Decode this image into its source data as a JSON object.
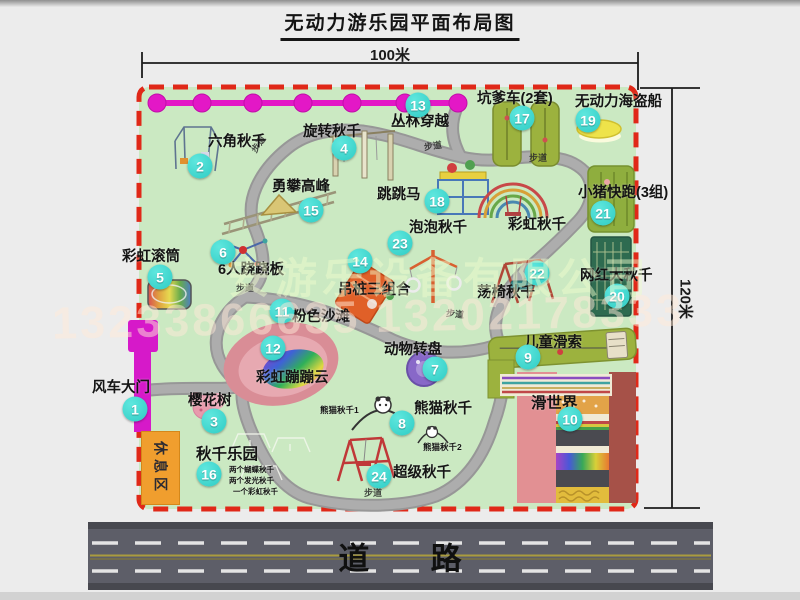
{
  "title": "无动力游乐园平面布局图",
  "dimensions": {
    "top": "100米",
    "right": "120米"
  },
  "road_label": "道 路",
  "walkway": "步道",
  "rest_area": "休息区",
  "watermark": {
    "company": "安游乐设备有限公司",
    "phone": "13233866635 13202178333"
  },
  "items": [
    {
      "num": "1",
      "label": "风车大门"
    },
    {
      "num": "2",
      "label": "六角秋千"
    },
    {
      "num": "3",
      "label": "樱花树"
    },
    {
      "num": "4",
      "label": "旋转秋千"
    },
    {
      "num": "5",
      "label": "彩虹滚筒"
    },
    {
      "num": "6",
      "label": "6人跷跷板"
    },
    {
      "num": "7",
      "label": "动物转盘"
    },
    {
      "num": "8",
      "label": "熊猫秋千"
    },
    {
      "num": "9",
      "label": "儿童滑索"
    },
    {
      "num": "10",
      "label": "滑世界"
    },
    {
      "num": "11",
      "label": "粉色沙滩"
    },
    {
      "num": "12",
      "label": "彩虹蹦蹦云"
    },
    {
      "num": "13",
      "label": "丛林穿越"
    },
    {
      "num": "14",
      "label": "吊桩三组合"
    },
    {
      "num": "15",
      "label": "勇攀高峰"
    },
    {
      "num": "16",
      "label": "秋千乐园"
    },
    {
      "num": "17",
      "label": "坑爹车(2套)"
    },
    {
      "num": "18",
      "label": "跳跳马"
    },
    {
      "num": "19",
      "label": "无动力海盗船"
    },
    {
      "num": "20",
      "label": "网红大秋千"
    },
    {
      "num": "21",
      "label": "小猪快跑(3组)"
    },
    {
      "num": "22",
      "label": "荡椅秋千"
    },
    {
      "num": "23",
      "label": "泡泡秋千"
    },
    {
      "num": "24",
      "label": "超级秋千"
    }
  ],
  "annotations": {
    "rainbow_swing": "彩虹秋千",
    "panda_swing_1": "熊猫秋千1",
    "panda_swing_2": "熊猫秋千2",
    "swing_note_1": "两个蝴蝶秋千",
    "swing_note_2": "两个发光秋千",
    "swing_note_3": "一个彩虹秋千"
  },
  "colors": {
    "map_green": "#cbe9c2",
    "border_red": "#e02818",
    "badge_teal": "#38d7ce",
    "magenta": "#e318c6",
    "road_gray": "#5d5e68",
    "rest_orange": "#f09e2e"
  }
}
